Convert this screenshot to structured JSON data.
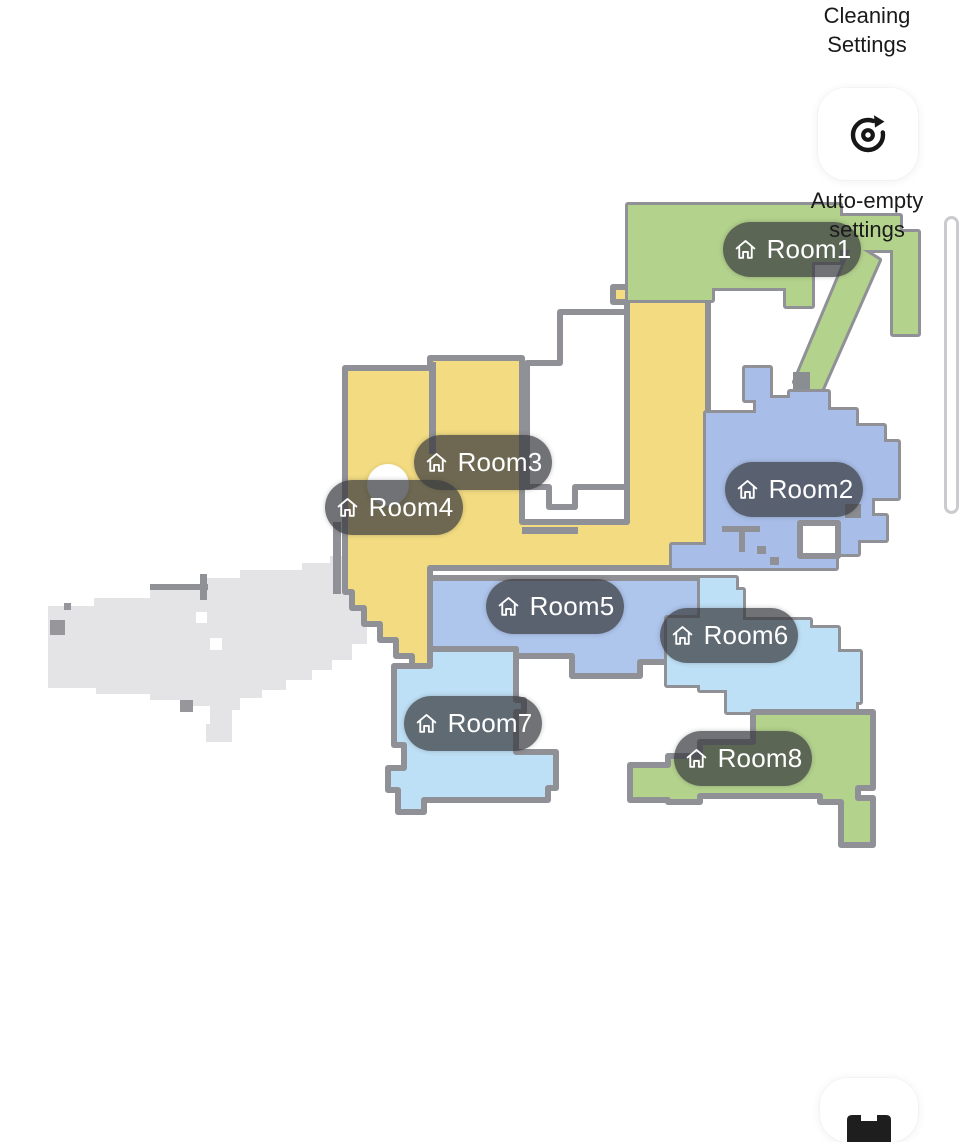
{
  "panel": {
    "title": "Cleaning Settings",
    "rotate_button": {
      "icon": "rotate-map-icon"
    },
    "auto_empty_label": "Auto-empty settings",
    "bottom_button": {
      "icon": "map-icon"
    }
  },
  "map": {
    "rooms": [
      {
        "name": "Room1",
        "color": "#b3d28c"
      },
      {
        "name": "Room2",
        "color": "#a8bee8"
      },
      {
        "name": "Room3",
        "color": "#f2db80"
      },
      {
        "name": "Room4",
        "color": "#f2db80"
      },
      {
        "name": "Room5",
        "color": "#aec5ec"
      },
      {
        "name": "Room6",
        "color": "#bee0f6"
      },
      {
        "name": "Room7",
        "color": "#bee0f6"
      },
      {
        "name": "Room8",
        "color": "#b3d28c"
      }
    ],
    "label_icon": "home-icon",
    "label_pill_color": "rgba(58,60,64,0.72)",
    "wall_color": "#8f9196",
    "unexplored_color": "#e4e4e6",
    "robot_marker": "robot-position"
  }
}
